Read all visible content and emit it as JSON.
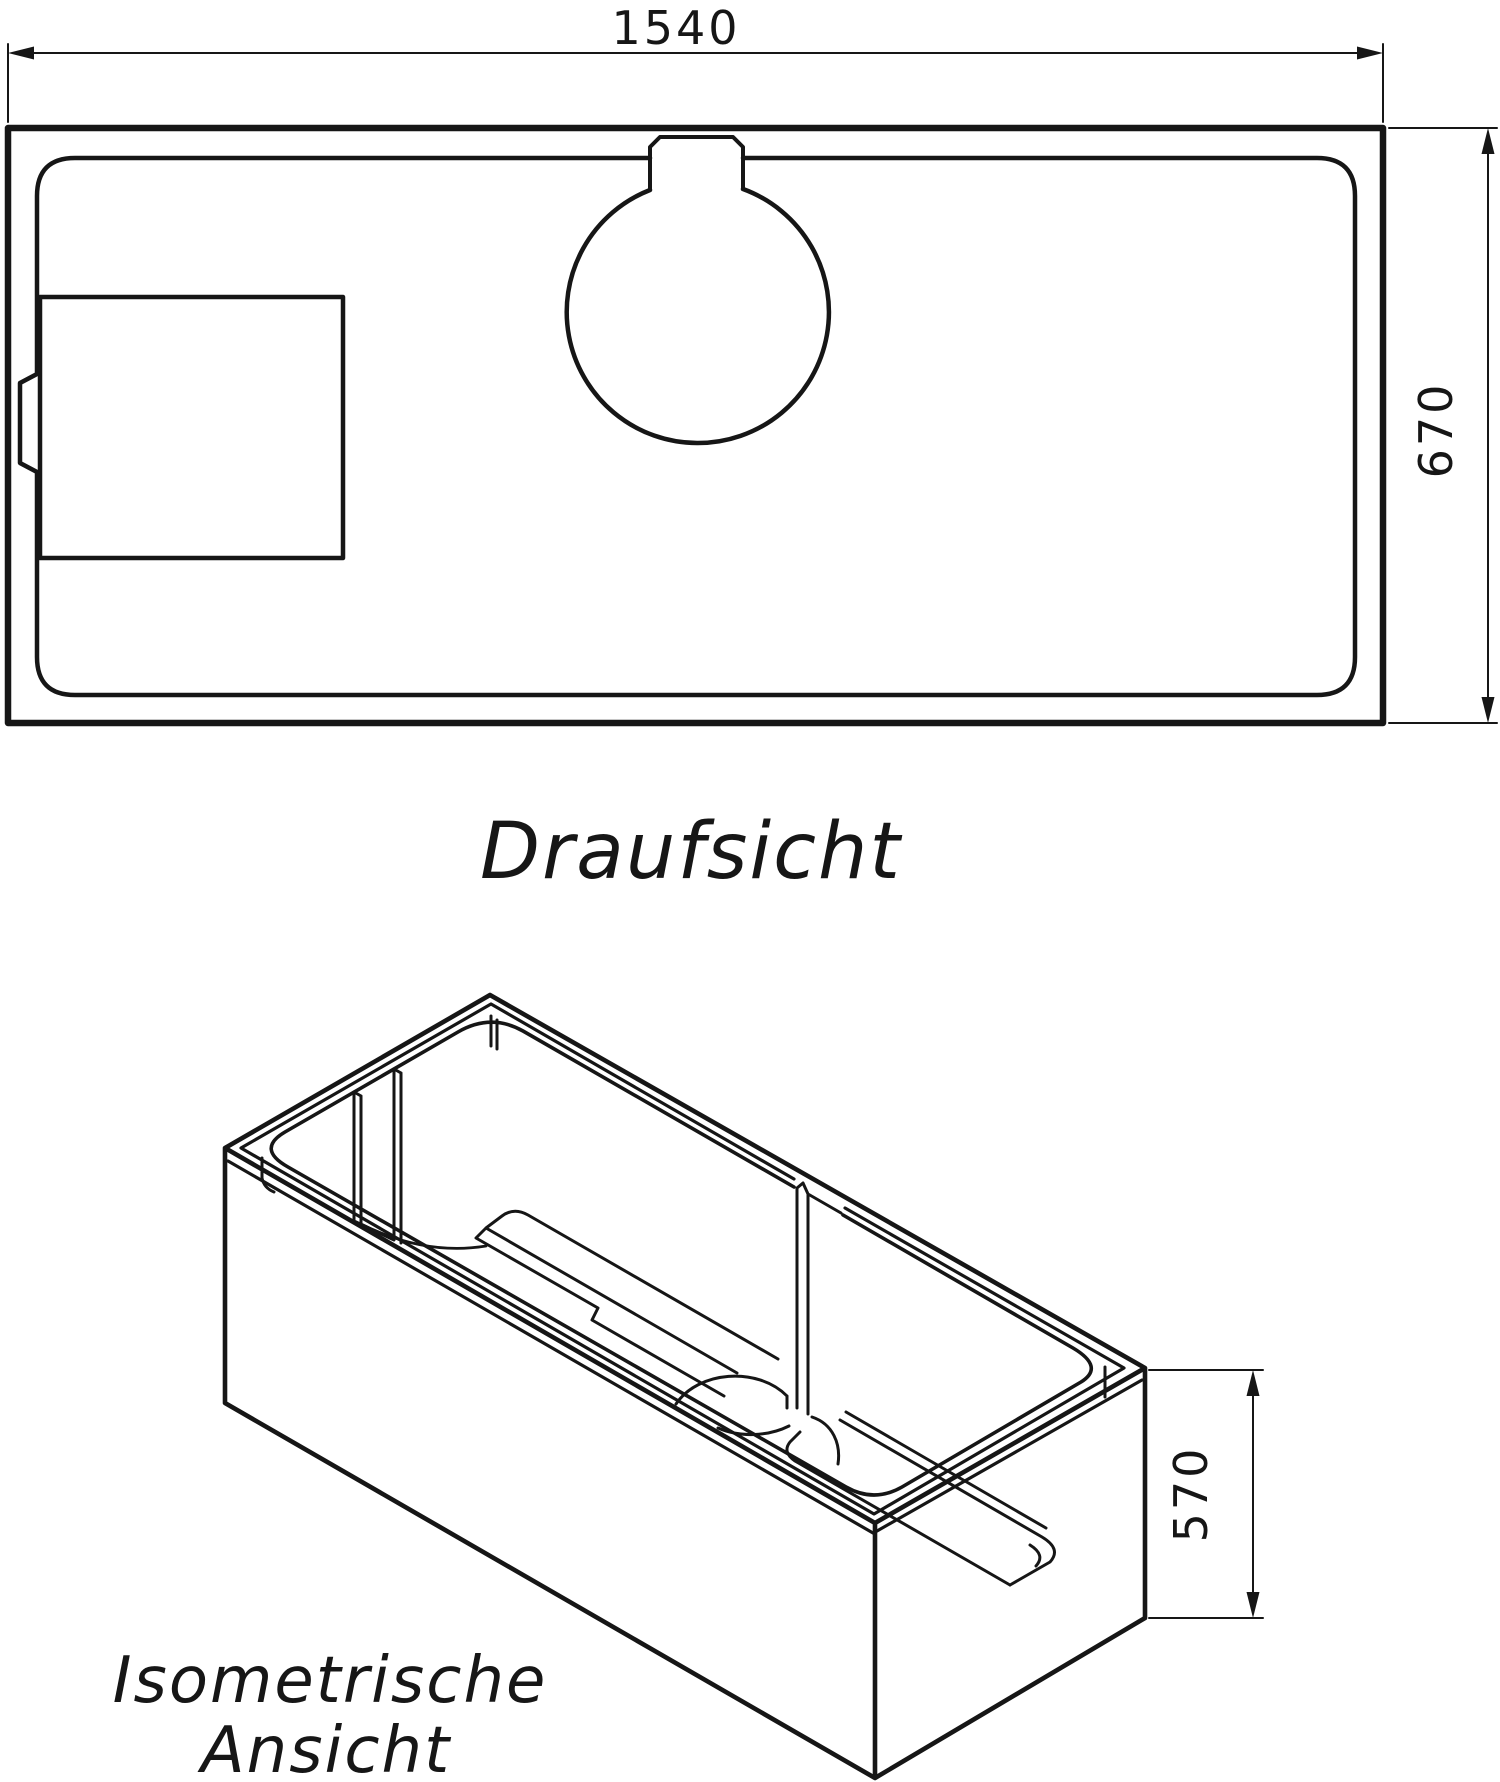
{
  "drawing": {
    "background": "#ffffff",
    "line_color": "#161616",
    "top_view": {
      "label": "Draufsicht",
      "width_dim": "1540",
      "height_dim": "670"
    },
    "iso_view": {
      "label_line1": "Isometrische",
      "label_line2": "Ansicht",
      "height_dim": "570"
    }
  }
}
